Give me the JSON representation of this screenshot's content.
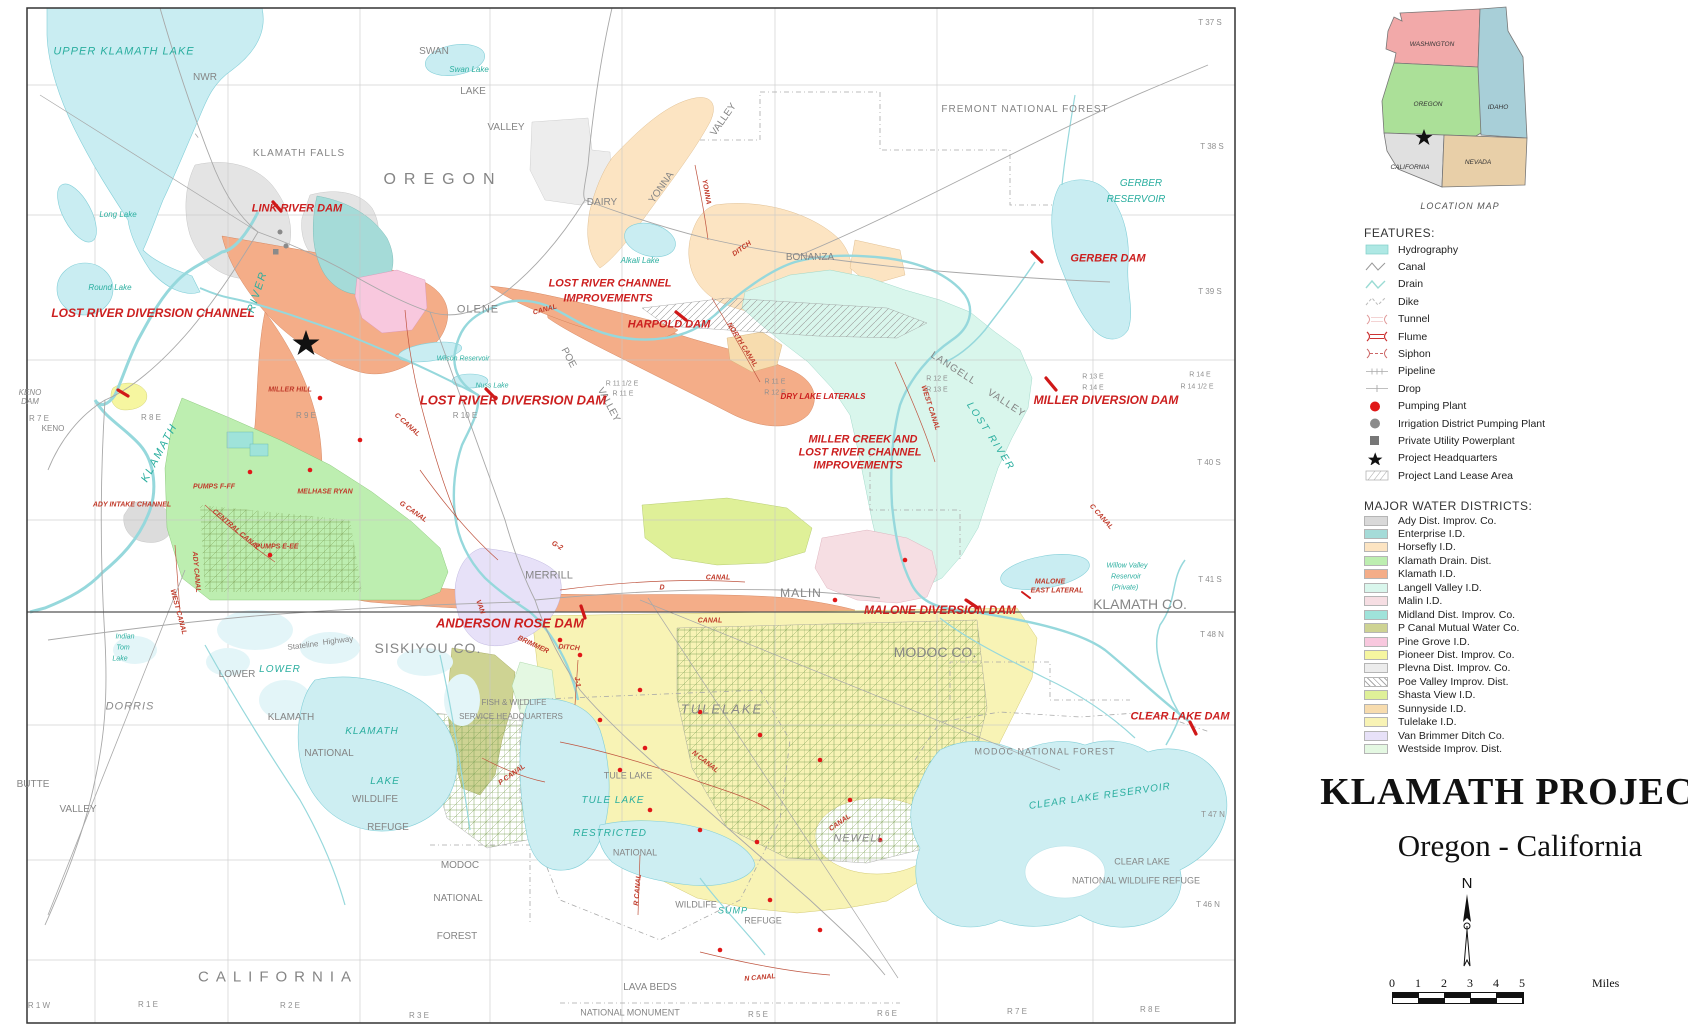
{
  "title_block": {
    "title": "KLAMATH PROJECT",
    "subtitle": "Oregon - California"
  },
  "north_arrow": {
    "label": "N"
  },
  "scale_bar": {
    "ticks": [
      "0",
      "1",
      "2",
      "3",
      "4",
      "5"
    ],
    "unit": "Miles"
  },
  "location_map": {
    "caption": "LOCATION MAP",
    "states": [
      {
        "name": "WASHINGTON",
        "color": "#f2a9a9",
        "x": 62,
        "y": 40
      },
      {
        "name": "OREGON",
        "color": "#abe098",
        "x": 58,
        "y": 100
      },
      {
        "name": "IDAHO",
        "color": "#a8cfd8",
        "x": 128,
        "y": 103
      },
      {
        "name": "CALIFORNIA",
        "color": "#e0e0e0",
        "x": 40,
        "y": 163
      },
      {
        "name": "NEVADA",
        "color": "#e8cfa8",
        "x": 108,
        "y": 158
      }
    ]
  },
  "features_legend": {
    "title": "FEATURES:",
    "items": [
      {
        "icon": "hydrography-swatch",
        "label": "Hydrography"
      },
      {
        "icon": "canal-line",
        "label": "Canal"
      },
      {
        "icon": "drain-line",
        "label": "Drain"
      },
      {
        "icon": "dike-line",
        "label": "Dike"
      },
      {
        "icon": "tunnel-symbol",
        "label": "Tunnel"
      },
      {
        "icon": "flume-symbol",
        "label": "Flume"
      },
      {
        "icon": "siphon-symbol",
        "label": "Siphon"
      },
      {
        "icon": "pipeline-symbol",
        "label": "Pipeline"
      },
      {
        "icon": "drop-symbol",
        "label": "Drop"
      },
      {
        "icon": "pumping-plant-dot",
        "label": "Pumping Plant"
      },
      {
        "icon": "district-pumping-plant-dot",
        "label": "Irrigation District Pumping Plant"
      },
      {
        "icon": "powerplant-square",
        "label": "Private Utility Powerplant"
      },
      {
        "icon": "headquarters-star",
        "label": "Project Headquarters"
      },
      {
        "icon": "lease-swatch",
        "label": "Project Land Lease Area"
      }
    ]
  },
  "districts_legend": {
    "title": "MAJOR WATER DISTRICTS:",
    "items": [
      {
        "color": "#d9d9d9",
        "label": "Ady Dist. Improv. Co."
      },
      {
        "color": "#a5dbd8",
        "label": "Enterprise I.D."
      },
      {
        "color": "#fce4c2",
        "label": "Horsefly I.D."
      },
      {
        "color": "#bdeeb0",
        "label": "Klamath Drain. Dist."
      },
      {
        "color": "#f4ad88",
        "label": "Klamath I.D."
      },
      {
        "color": "#d9f6ec",
        "label": "Langell Valley I.D."
      },
      {
        "color": "#f6dee3",
        "label": "Malin I.D."
      },
      {
        "color": "#9fe3da",
        "label": "Midland Dist. Improv. Co."
      },
      {
        "color": "#ced393",
        "label": "P Canal Mutual Water Co."
      },
      {
        "color": "#f8c8de",
        "label": "Pine Grove I.D."
      },
      {
        "color": "#f6f6a0",
        "label": "Pioneer Dist. Improv. Co."
      },
      {
        "color": "#ececec",
        "label": "Plevna Dist. Improv. Co."
      },
      {
        "color": "#ffffff",
        "hatch": true,
        "label": "Poe Valley Improv. Dist."
      },
      {
        "color": "#dff098",
        "label": "Shasta View I.D."
      },
      {
        "color": "#f7dcae",
        "label": "Sunnyside I.D."
      },
      {
        "color": "#f8f3b5",
        "label": "Tulelake I.D."
      },
      {
        "color": "#e7e1f8",
        "label": "Van Brimmer Ditch Co."
      },
      {
        "color": "#e4f8e2",
        "label": "Westside Improv. Dist."
      }
    ]
  },
  "map": {
    "labels": [
      [
        "UPPER KLAMATH LAKE",
        124,
        52,
        "w",
        11,
        0,
        1
      ],
      [
        "NWR",
        205,
        78,
        "p",
        10
      ],
      [
        "KLAMATH FALLS",
        299,
        154,
        "p",
        10,
        0,
        1
      ],
      [
        "OREGON",
        443,
        180,
        "p",
        16,
        0,
        8
      ],
      [
        "SWAN",
        434,
        52,
        "p",
        10
      ],
      [
        "Swan Lake",
        469,
        70,
        "w",
        8
      ],
      [
        "LAKE",
        473,
        92,
        "p",
        10
      ],
      [
        "VALLEY",
        506,
        128,
        "p",
        10
      ],
      [
        "FREMONT  NATIONAL  FOREST",
        1025,
        110,
        "p",
        10,
        0,
        1
      ],
      [
        "DAIRY",
        602,
        203,
        "p",
        10
      ],
      [
        "BONANZA",
        810,
        258,
        "p",
        10
      ],
      [
        "GERBER",
        1141,
        184,
        "w",
        10
      ],
      [
        "RESERVOIR",
        1136,
        200,
        "w",
        10
      ],
      [
        "GERBER DAM",
        1108,
        259,
        "d",
        11
      ],
      [
        "T 37 S",
        1210,
        23,
        "e",
        8
      ],
      [
        "T 38 S",
        1212,
        147,
        "e",
        8
      ],
      [
        "T 39 S",
        1210,
        292,
        "e",
        8
      ],
      [
        "T 40 S",
        1209,
        463,
        "e",
        8
      ],
      [
        "T 41 S",
        1210,
        580,
        "e",
        8
      ],
      [
        "T 48 N",
        1212,
        635,
        "e",
        8
      ],
      [
        "T 47 N",
        1213,
        815,
        "e",
        8
      ],
      [
        "T 46 N",
        1208,
        905,
        "e",
        8
      ],
      [
        "LINK RIVER DAM",
        297,
        209,
        "d",
        11
      ],
      [
        "Long Lake",
        118,
        215,
        "w",
        8
      ],
      [
        "Round Lake",
        110,
        288,
        "w",
        8
      ],
      [
        "LOST RIVER DIVERSION CHANNEL",
        153,
        313,
        "d",
        12
      ],
      [
        "KENO",
        30,
        393,
        "pi",
        8
      ],
      [
        "DAM",
        30,
        402,
        "pi",
        8
      ],
      [
        "KENO",
        53,
        429,
        "p",
        8
      ],
      [
        "R 7 E",
        39,
        419,
        "e",
        8
      ],
      [
        "R 8 E",
        151,
        418,
        "e",
        8
      ],
      [
        "R 9 E",
        306,
        416,
        "e",
        8
      ],
      [
        "R 10 E",
        465,
        416,
        "e",
        8
      ],
      [
        "OLENE",
        478,
        310,
        "p",
        11,
        0,
        1
      ],
      [
        "POE",
        568,
        358,
        "p",
        10,
        62
      ],
      [
        "VALLEY",
        608,
        405,
        "p",
        10,
        62
      ],
      [
        "YONNA",
        662,
        188,
        "p",
        10,
        -55
      ],
      [
        "VALLEY",
        724,
        120,
        "p",
        10,
        -55
      ],
      [
        "Alkali Lake",
        640,
        261,
        "w",
        8
      ],
      [
        "LOST RIVER CHANNEL",
        610,
        284,
        "d",
        11
      ],
      [
        "IMPROVEMENTS",
        608,
        299,
        "d",
        11
      ],
      [
        "HARPOLD DAM",
        669,
        325,
        "d",
        11
      ],
      [
        "LOST RIVER DIVERSION DAM",
        513,
        400,
        "d",
        13
      ],
      [
        "R 11 1/2 E",
        622,
        384,
        "e",
        7
      ],
      [
        "R 11 E",
        623,
        394,
        "e",
        7
      ],
      [
        "R 11 E",
        775,
        382,
        "e",
        7
      ],
      [
        "R 12 E",
        775,
        393,
        "e",
        7
      ],
      [
        "R 12 E",
        937,
        379,
        "e",
        7
      ],
      [
        "R 13 E",
        937,
        390,
        "e",
        7
      ],
      [
        "R 13 E",
        1093,
        377,
        "e",
        7
      ],
      [
        "R 14 E",
        1093,
        388,
        "e",
        7
      ],
      [
        "R 14 E",
        1200,
        375,
        "e",
        7
      ],
      [
        "R 14 1/2 E",
        1197,
        387,
        "e",
        7
      ],
      [
        "DRY LAKE LATERALS",
        823,
        397,
        "d",
        8
      ],
      [
        "MILLER DIVERSION DAM",
        1106,
        400,
        "d",
        12
      ],
      [
        "LANGELL",
        953,
        369,
        "p",
        10,
        33,
        1
      ],
      [
        "VALLEY",
        1006,
        404,
        "p",
        10,
        33,
        1
      ],
      [
        "LOST RIVER",
        990,
        437,
        "w",
        10,
        57,
        2
      ],
      [
        "MILLER CREEK AND",
        863,
        440,
        "d",
        11
      ],
      [
        "LOST RIVER CHANNEL",
        860,
        453,
        "d",
        11
      ],
      [
        "IMPROVEMENTS",
        858,
        466,
        "d",
        11
      ],
      [
        "Wilson Reservoir",
        463,
        359,
        "w",
        7
      ],
      [
        "Nuss Lake",
        492,
        386,
        "w",
        7
      ],
      [
        "KLAMATH",
        160,
        453,
        "w",
        11,
        -62,
        2
      ],
      [
        "RIVER",
        258,
        292,
        "w",
        11,
        -72,
        2
      ],
      [
        "MILLER HILL",
        290,
        390,
        "c",
        7
      ],
      [
        "MELHASE RYAN",
        325,
        492,
        "c",
        7
      ],
      [
        "PUMPS F-FF",
        214,
        487,
        "c",
        7
      ],
      [
        "PUMPS E-EE",
        277,
        547,
        "c",
        7
      ],
      [
        "ADY INTAKE CHANNEL",
        132,
        505,
        "c",
        7
      ],
      [
        "NORTH CANAL",
        742,
        345,
        "c",
        7,
        58
      ],
      [
        "WEST CANAL",
        930,
        408,
        "c",
        7,
        72
      ],
      [
        "C CANAL",
        407,
        425,
        "c",
        7,
        42
      ],
      [
        "G CANAL",
        413,
        512,
        "c",
        7,
        35
      ],
      [
        "G-2",
        557,
        546,
        "c",
        7,
        30
      ],
      [
        "C CANAL",
        1101,
        517,
        "c",
        7,
        48
      ],
      [
        "YONNA",
        706,
        192,
        "c",
        7,
        80
      ],
      [
        "DITCH",
        742,
        249,
        "c",
        7,
        -35
      ],
      [
        "CANAL",
        545,
        310,
        "c",
        7,
        -15
      ],
      [
        "MALONE DIVERSION DAM",
        940,
        610,
        "d",
        12
      ],
      [
        "MALONE",
        1050,
        582,
        "c",
        7
      ],
      [
        "EAST LATERAL",
        1057,
        591,
        "c",
        7
      ],
      [
        "Willow Valley",
        1127,
        566,
        "w",
        7
      ],
      [
        "Reservoir",
        1126,
        577,
        "w",
        7
      ],
      [
        "(Private)",
        1125,
        588,
        "w",
        7
      ],
      [
        "KLAMATH CO.",
        1140,
        604,
        "p",
        14
      ],
      [
        "MODOC CO.",
        935,
        652,
        "p",
        14
      ],
      [
        "SISKIYOU CO.",
        428,
        648,
        "p",
        14,
        0,
        1
      ],
      [
        "ANDERSON ROSE DAM",
        510,
        623,
        "d",
        13
      ],
      [
        "MERRILL",
        549,
        576,
        "p",
        11
      ],
      [
        "MALIN",
        801,
        593,
        "p",
        12,
        0,
        1
      ],
      [
        "D",
        662,
        588,
        "c",
        7
      ],
      [
        "CANAL",
        718,
        578,
        "c",
        7
      ],
      [
        "CANAL",
        710,
        621,
        "c",
        7
      ],
      [
        "VAN",
        480,
        607,
        "c",
        7,
        70
      ],
      [
        "BRIMMER",
        533,
        645,
        "c",
        7,
        25
      ],
      [
        "DITCH",
        569,
        648,
        "c",
        7,
        5
      ],
      [
        "Stateline",
        303,
        646,
        "p",
        8,
        -7
      ],
      [
        "Highway",
        338,
        641,
        "p",
        8,
        -7
      ],
      [
        "Indian",
        125,
        637,
        "w",
        7
      ],
      [
        "Tom",
        123,
        648,
        "w",
        7
      ],
      [
        "Lake",
        120,
        659,
        "w",
        7
      ],
      [
        "LOWER",
        237,
        675,
        "p",
        10
      ],
      [
        "LOWER",
        280,
        670,
        "w",
        10,
        0,
        1
      ],
      [
        "KLAMATH",
        291,
        718,
        "p",
        10
      ],
      [
        "NATIONAL",
        329,
        754,
        "p",
        10
      ],
      [
        "WILDLIFE",
        375,
        800,
        "p",
        10
      ],
      [
        "REFUGE",
        388,
        828,
        "p",
        10
      ],
      [
        "KLAMATH",
        372,
        732,
        "w",
        10,
        0,
        1
      ],
      [
        "LAKE",
        385,
        782,
        "w",
        10,
        0,
        1
      ],
      [
        "DORRIS",
        130,
        707,
        "pi",
        11,
        0,
        1
      ],
      [
        "BUTTE",
        33,
        785,
        "p",
        10
      ],
      [
        "VALLEY",
        78,
        810,
        "p",
        10
      ],
      [
        "FISH & WILDLIFE",
        514,
        703,
        "p",
        8
      ],
      [
        "SERVICE HEADQUARTERS",
        511,
        717,
        "p",
        8
      ],
      [
        "TULE LAKE",
        628,
        776,
        "p",
        9
      ],
      [
        "TULE LAKE",
        613,
        801,
        "w",
        10,
        0,
        1
      ],
      [
        "RESTRICTED",
        610,
        834,
        "w",
        10,
        0,
        1
      ],
      [
        "TULELAKE",
        722,
        709,
        "pi",
        13,
        0,
        2
      ],
      [
        "NEWELL",
        859,
        839,
        "pi",
        11,
        0,
        1
      ],
      [
        "NATIONAL",
        635,
        853,
        "p",
        9
      ],
      [
        "WILDLIFE",
        696,
        905,
        "p",
        9
      ],
      [
        "SUMP",
        733,
        911,
        "w",
        9,
        0,
        1
      ],
      [
        "REFUGE",
        763,
        921,
        "p",
        9
      ],
      [
        "J-1",
        577,
        682,
        "c",
        7,
        80
      ],
      [
        "N CANAL",
        705,
        762,
        "c",
        7,
        38
      ],
      [
        "P CANAL",
        512,
        775,
        "c",
        7,
        -35
      ],
      [
        "R CANAL",
        638,
        890,
        "c",
        7,
        -85
      ],
      [
        "N CANAL",
        760,
        978,
        "c",
        7,
        -5
      ],
      [
        "CANAL",
        840,
        823,
        "c",
        7,
        -35
      ],
      [
        "ADY CANAL",
        196,
        572,
        "c",
        7,
        85
      ],
      [
        "WEST CANAL",
        178,
        612,
        "c",
        7,
        75
      ],
      [
        "CENTRAL CANAL",
        236,
        530,
        "c",
        7,
        40
      ],
      [
        "MODOC",
        460,
        866,
        "p",
        10
      ],
      [
        "NATIONAL",
        458,
        899,
        "p",
        10
      ],
      [
        "FOREST",
        457,
        937,
        "p",
        10
      ],
      [
        "MODOC NATIONAL FOREST",
        1045,
        752,
        "p",
        9,
        0,
        1
      ],
      [
        "CLEAR LAKE DAM",
        1180,
        717,
        "d",
        11
      ],
      [
        "CLEAR LAKE RESERVOIR",
        1100,
        797,
        "w",
        10,
        -8,
        1
      ],
      [
        "CLEAR LAKE",
        1142,
        862,
        "p",
        9
      ],
      [
        "NATIONAL WILDLIFE REFUGE",
        1136,
        881,
        "p",
        9
      ],
      [
        "LAVA BEDS",
        650,
        988,
        "p",
        10
      ],
      [
        "NATIONAL MONUMENT",
        630,
        1013,
        "p",
        9
      ],
      [
        "CALIFORNIA",
        278,
        977,
        "p",
        15,
        0,
        7
      ],
      [
        "R 1 W",
        39,
        1006,
        "e",
        8
      ],
      [
        "R 1 E",
        148,
        1005,
        "e",
        8
      ],
      [
        "R 2 E",
        290,
        1006,
        "e",
        8
      ],
      [
        "R 3 E",
        419,
        1016,
        "e",
        8
      ],
      [
        "R 5 E",
        758,
        1015,
        "e",
        8
      ],
      [
        "R 6 E",
        887,
        1014,
        "e",
        8
      ],
      [
        "R 7 E",
        1017,
        1012,
        "e",
        8
      ],
      [
        "R 8 E",
        1150,
        1010,
        "e",
        8
      ]
    ]
  }
}
